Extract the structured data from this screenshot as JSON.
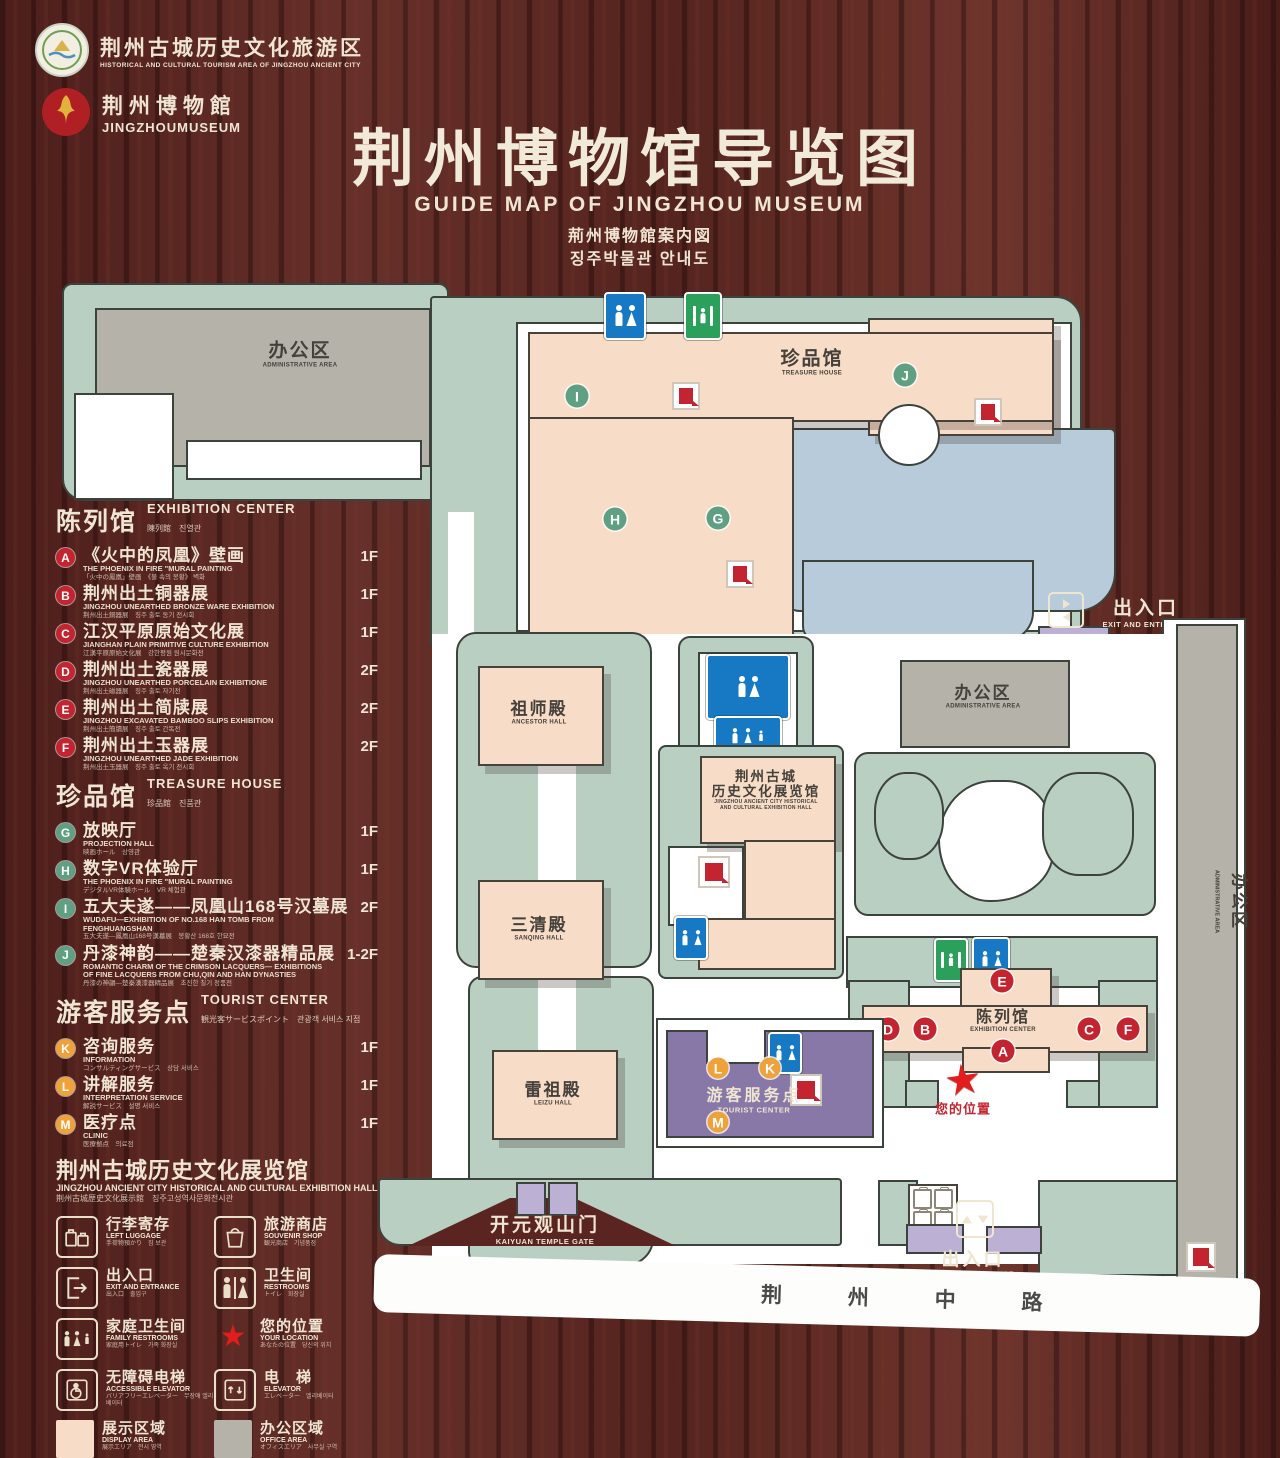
{
  "header": {
    "logo1": {
      "cn": "荆州古城历史文化旅游区",
      "en": "HISTORICAL AND CULTURAL TOURISM AREA OF JINGZHOU ANCIENT CITY"
    },
    "logo2": {
      "cn": "荆州博物館",
      "en": "JINGZHOUMUSEUM"
    },
    "title": "荆州博物馆导览图",
    "subtitle_en": "GUIDE MAP OF JINGZHOU MUSEUM",
    "subtitle_ja": "荊州博物館案内図",
    "subtitle_ko": "징주박물관 안내도"
  },
  "legend": {
    "sections": [
      {
        "id": "exhibition-center",
        "title_cn": "陈列馆",
        "title_en": "EXHIBITION CENTER",
        "title_sub": "陳列館　진열관",
        "marker_class": "red",
        "items": [
          {
            "letter": "A",
            "cn": "《火中的凤凰》壁画",
            "en": "THE PHOENIX IN FIRE \"MURAL PAINTING",
            "sub": "「火中の鳳凰」壁画　《불 속의 봉황》 벽화",
            "floor": "1F"
          },
          {
            "letter": "B",
            "cn": "荆州出土铜器展",
            "en": "JINGZHOU UNEARTHED BRONZE WARE EXHIBITION",
            "sub": "荆州出土銅器展　징주 출토 동기 전시회",
            "floor": "1F"
          },
          {
            "letter": "C",
            "cn": "江汉平原原始文化展",
            "en": "JIANGHAN PLAIN PRIMITIVE CULTURE EXHIBITION",
            "sub": "江漢平原原始文化展　강한평원 원시문화전",
            "floor": "1F"
          },
          {
            "letter": "D",
            "cn": "荆州出土瓷器展",
            "en": "JINGZHOU UNEARTHED PORCELAIN EXHIBITIONE",
            "sub": "荆州出土磁器展　징주 출토 자기전",
            "floor": "2F"
          },
          {
            "letter": "E",
            "cn": "荆州出土简牍展",
            "en": "JINGZHOU EXCAVATED BAMBOO SLIPS EXHIBITION",
            "sub": "荆州出土簡牘展　징주 출토 간독전",
            "floor": "2F"
          },
          {
            "letter": "F",
            "cn": "荆州出土玉器展",
            "en": "JINGZHOU UNEARTHED JADE EXHIBITION",
            "sub": "荆州出土玉器展　징주 출토 옥기 전시회",
            "floor": "2F"
          }
        ]
      },
      {
        "id": "treasure-house",
        "title_cn": "珍品馆",
        "title_en": "TREASURE HOUSE",
        "title_sub": "珍品館　진품관",
        "marker_class": "grn",
        "items": [
          {
            "letter": "G",
            "cn": "放映厅",
            "en": "PROJECTION HALL",
            "sub": "映画ホール　상영관",
            "floor": "1F"
          },
          {
            "letter": "H",
            "cn": "数字VR体验厅",
            "en": "THE PHOENIX IN FIRE \"MURAL PAINTING",
            "sub": "デジタルVR体験ホール　VR 체험관",
            "floor": "1F"
          },
          {
            "letter": "I",
            "cn": "五大夫遂——凤凰山168号汉墓展",
            "en": "WUDAFU—EXHIBITION OF NO.168 HAN TOMB FROM FENGHUANGSHAN",
            "sub": "五大夫遂—鳳凰山168号漢墓展　봉황산 168호 한묘전",
            "floor": "2F"
          },
          {
            "letter": "J",
            "cn": "丹漆神韵——楚秦汉漆器精品展",
            "en": "ROMANTIC CHARM OF THE CRIMSON LACQUERS— EXHIBITIONS OF FINE LACQUERS FROM CHU,QIN AND HAN DYNASTIES",
            "sub": "丹漆の神韻—楚秦漢漆器精品展　초진한 칠기 정품전",
            "floor": "1-2F"
          }
        ]
      },
      {
        "id": "tourist-center",
        "title_cn": "游客服务点",
        "title_en": "TOURIST CENTER",
        "title_sub": "観光客サービスポイント　관광객 서비스 지점",
        "marker_class": "org",
        "items": [
          {
            "letter": "K",
            "cn": "咨询服务",
            "en": "INFORMATION",
            "sub": "コンサルティングサービス　상담 서비스",
            "floor": "1F"
          },
          {
            "letter": "L",
            "cn": "讲解服务",
            "en": "INTERPRETATION SERVICE",
            "sub": "解説サービス　설명 서비스",
            "floor": "1F"
          },
          {
            "letter": "M",
            "cn": "医疗点",
            "en": "CLINIC",
            "sub": "医療拠点　의료점",
            "floor": "1F"
          }
        ]
      }
    ],
    "hall_note": {
      "cn": "荆州古城历史文化展览馆",
      "en": "JINGZHOU ANCIENT CITY HISTORICAL AND CULTURAL EXHIBITION HALL",
      "sub": "荆州古城歴史文化展示館　징주고성역사문화전시관"
    },
    "icons": [
      {
        "key": "left-luggage",
        "cn": "行李寄存",
        "en": "LEFT LUGGAGE",
        "sub": "手荷物預かり　짐 보관"
      },
      {
        "key": "souvenir-shop",
        "cn": "旅游商店",
        "en": "SOUVENIR SHOP",
        "sub": "観光商店　기념품점"
      },
      {
        "key": "exit-entrance",
        "cn": "出入口",
        "en": "EXIT AND ENTRANCE",
        "sub": "出入口　출입구"
      },
      {
        "key": "restrooms",
        "cn": "卫生间",
        "en": "RESTROOMS",
        "sub": "トイレ　화장실"
      },
      {
        "key": "family-restrooms",
        "cn": "家庭卫生间",
        "en": "FAMILY RESTROOMS",
        "sub": "家庭用トイレ　가족 화장실"
      },
      {
        "key": "your-location",
        "cn": "您的位置",
        "en": "YOUR LOCATION",
        "sub": "あなたの位置　당신의 위치"
      },
      {
        "key": "accessible-elevator",
        "cn": "无障碍电梯",
        "en": "ACCESSIBLE ELEVATOR",
        "sub": "バリアフリーエレベーター　무장애 엘리베이터"
      },
      {
        "key": "elevator",
        "cn": "电　梯",
        "en": "ELEVATOR",
        "sub": "エレベーター　엘리베이터"
      }
    ],
    "areas": [
      {
        "key": "display-area",
        "cn": "展示区域",
        "en": "DISPLAY AREA",
        "sub": "展示エリア　전시 영역",
        "color": "#f7dcc7"
      },
      {
        "key": "office-area",
        "cn": "办公区域",
        "en": "OFFICE AREA",
        "sub": "オフィスエリア　사무실 구역",
        "color": "#b4b2a9"
      }
    ]
  },
  "map": {
    "admin_tl_cn": "办公区",
    "admin_tl_en": "ADMINISTRATIVE AREA",
    "treasure_cn": "珍品馆",
    "treasure_en": "TREASURE HOUSE",
    "ancestor_cn": "祖师殿",
    "ancestor_en": "ANCESTOR HALL",
    "sanqing_cn": "三清殿",
    "sanqing_en": "SANQING HALL",
    "leizu_cn": "雷祖殿",
    "leizu_en": "LEIZU HALL",
    "exhhall_cn1": "荆州古城",
    "exhhall_cn2": "历史文化展览馆",
    "exhhall_en1": "JINGZHOU ANCIENT CITY HISTORICAL",
    "exhhall_en2": "AND CULTURAL EXHIBITION HALL",
    "admin_mid_cn": "办公区",
    "admin_mid_en": "ADMINISTRATIVE AREA",
    "admin_right_cn": "办公区",
    "admin_right_en": "ADMINISTRATIVE AREA",
    "exhcenter_cn": "陈列馆",
    "exhcenter_en": "EXHIBITION CENTER",
    "tc_cn": "游客服务点",
    "tc_en": "TOURIST CENTER",
    "loc_cn": "您的位置",
    "exit_right_cn": "出入口",
    "exit_right_en": "EXIT AND ENTRANCE",
    "exit_bottom_cn": "出入口",
    "exit_bottom_en": "EXIT AND ENTRANCE",
    "gate_cn": "开元观山门",
    "gate_en": "KAIYUAN TEMPLE GATE",
    "road_cn": "荆 州 中 路",
    "markers": {
      "A": "A",
      "B": "B",
      "C": "C",
      "D": "D",
      "E": "E",
      "F": "F",
      "G": "G",
      "H": "H",
      "I": "I",
      "J": "J",
      "K": "K",
      "L": "L",
      "M": "M"
    },
    "colors": {
      "display": "#f7dcc7",
      "office": "#b4b2a9",
      "water": "#b7cbdb",
      "ground": "#b9cfc2",
      "tourist": "#8878a8",
      "marker_red": "#c32430",
      "marker_green": "#5ea081",
      "marker_orange": "#f0a23a",
      "sign_blue": "#1779c4",
      "sign_green": "#2ba05a",
      "star_red": "#e11d1d"
    }
  }
}
